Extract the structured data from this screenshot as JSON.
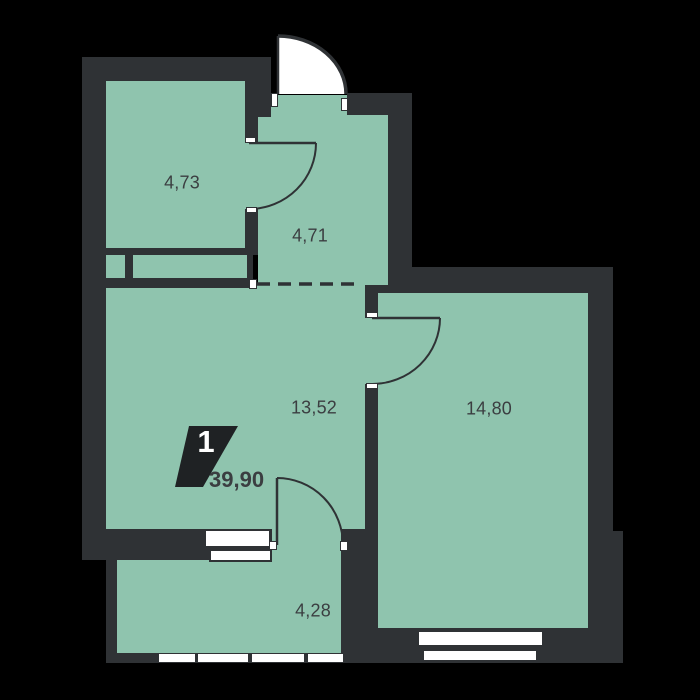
{
  "rooms": [
    {
      "area": "4,73"
    },
    {
      "area": "4,71"
    },
    {
      "area": "13,52"
    },
    {
      "area": "14,80"
    },
    {
      "area": "4,28"
    }
  ],
  "total_area": "39,90",
  "apartment_type_badge": "1",
  "colors": {
    "background": "#000000",
    "wall": "#2f3235",
    "floor": "#8fc4ae",
    "badge_background": "#1f2224",
    "label_text": "#3b3e41",
    "door_swing": "#ffffff"
  }
}
